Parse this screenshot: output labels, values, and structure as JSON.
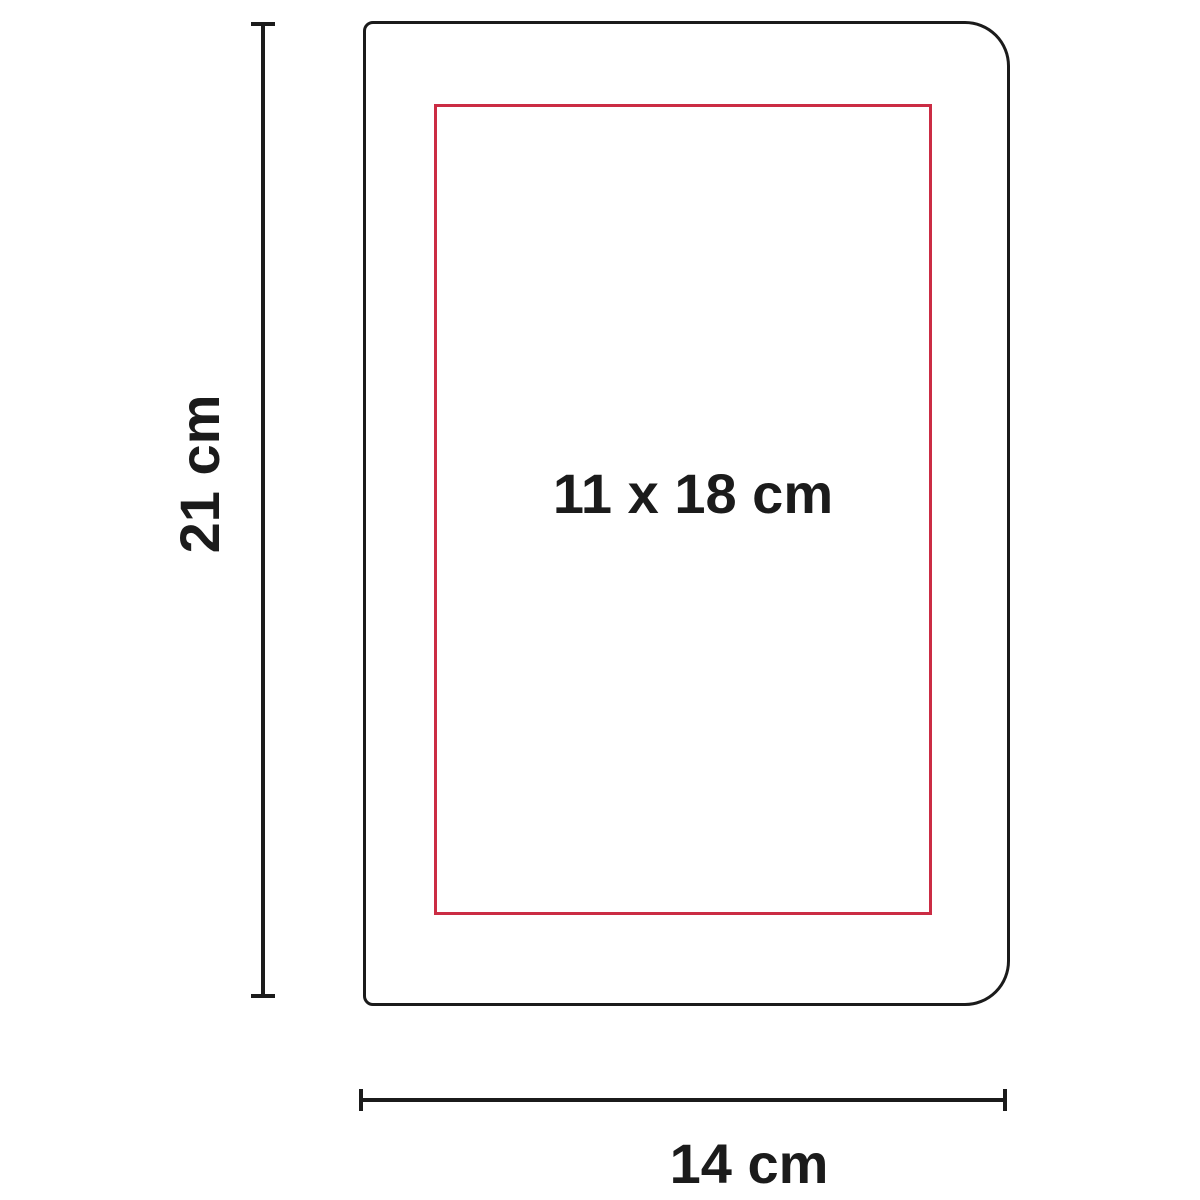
{
  "diagram": {
    "type": "product-dimension-diagram",
    "product_outline": {
      "height_label": "21 cm",
      "width_label": "14 cm"
    },
    "print_area": {
      "label": "11 x 18 cm"
    }
  },
  "colors": {
    "outline": "#1b1b1b",
    "print-area": "#cb2c44",
    "dimension": "#1b1b1b",
    "text": "#1b1b1b",
    "background": "#ffffff"
  }
}
